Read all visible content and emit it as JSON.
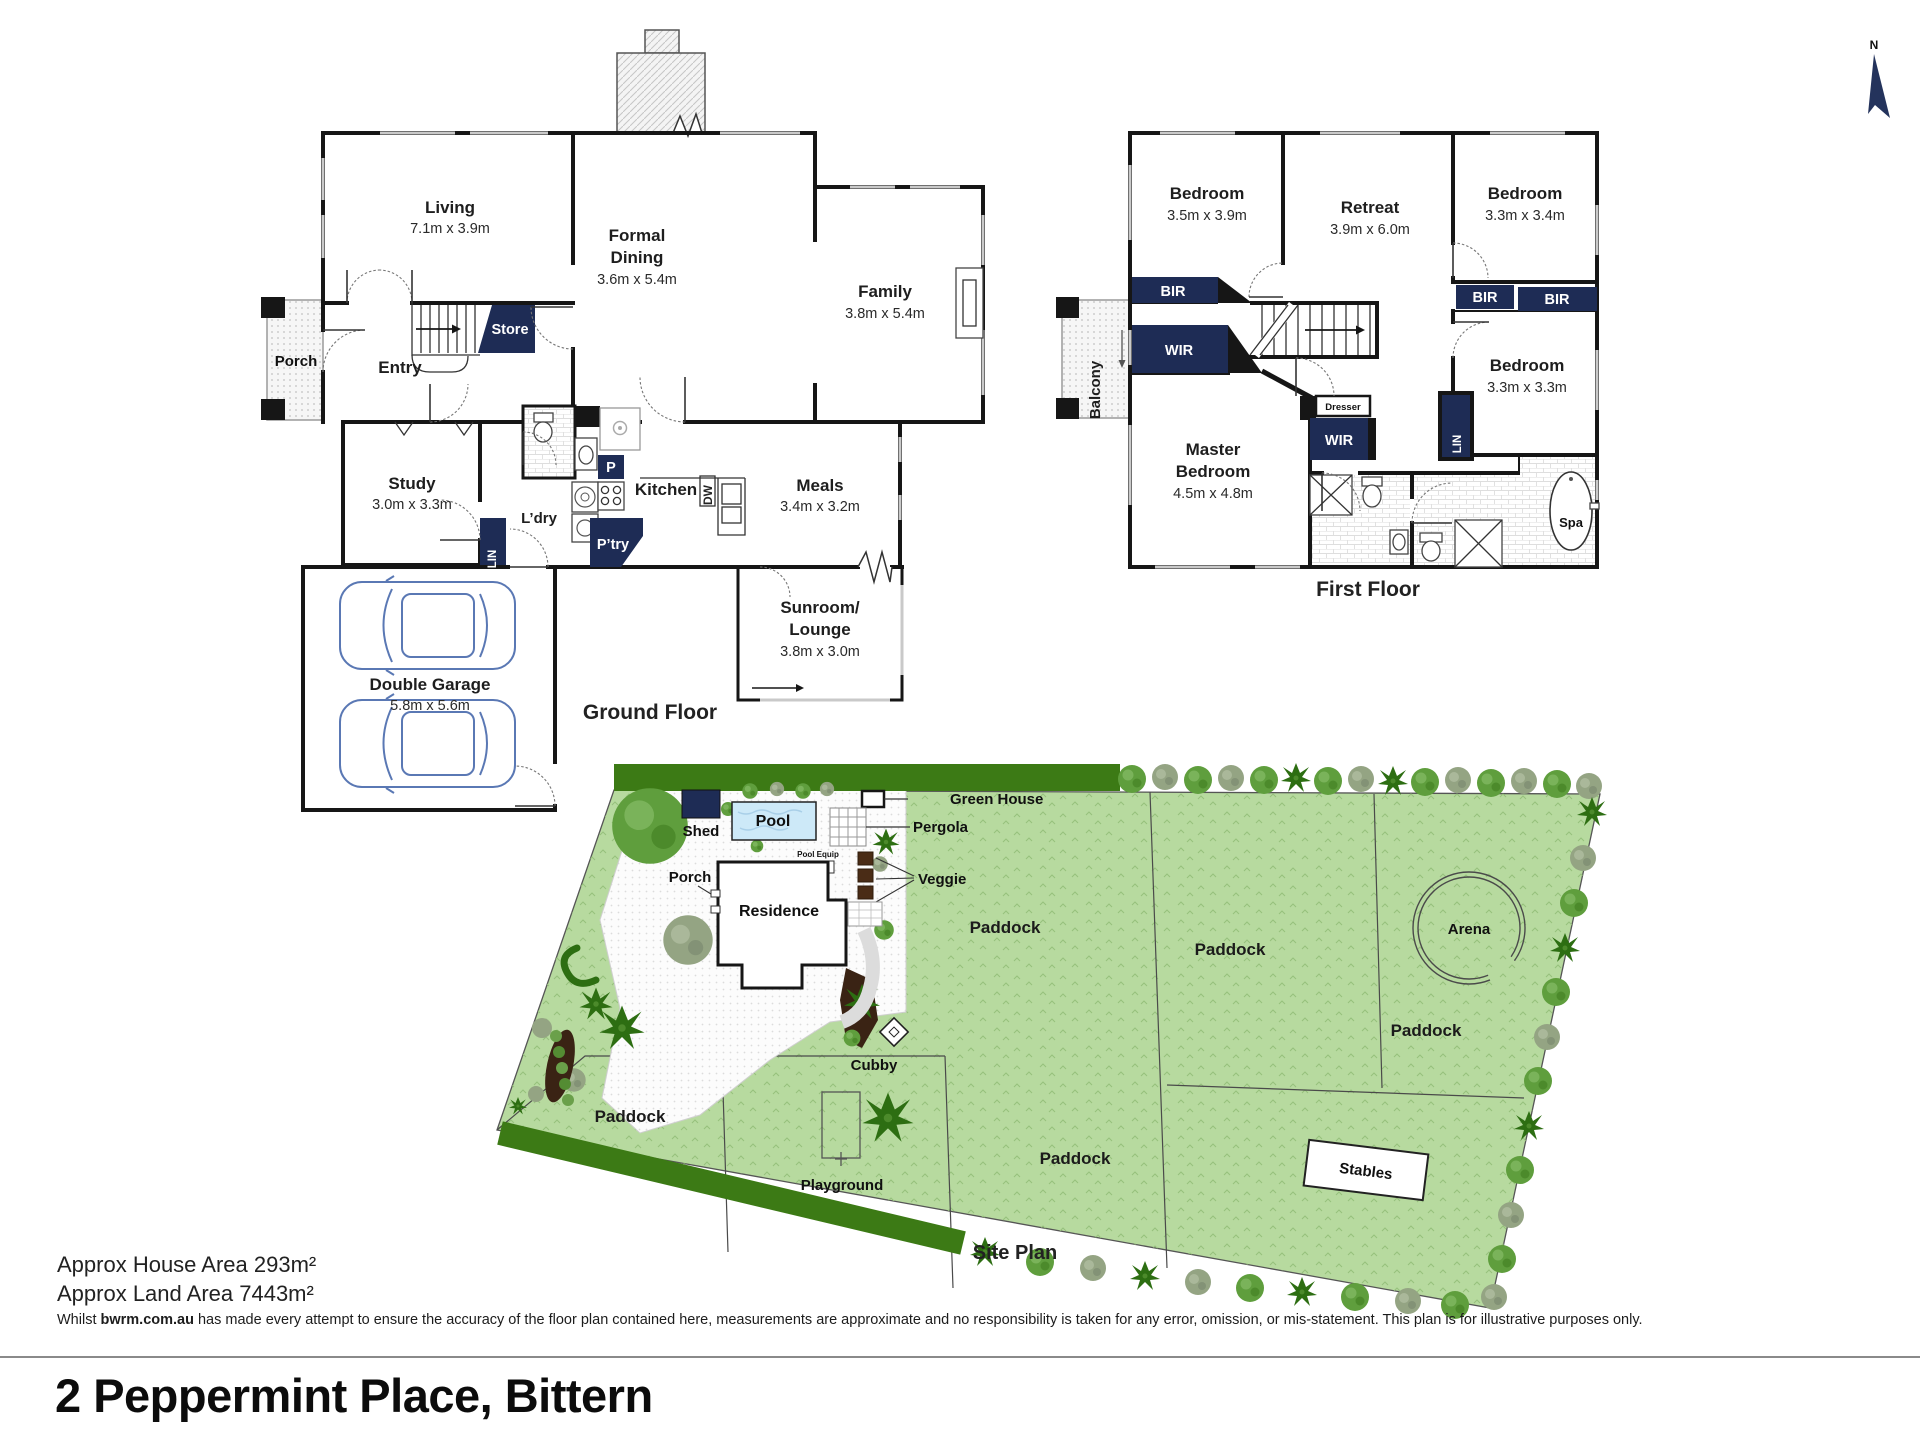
{
  "colors": {
    "navy": "#1e2c55",
    "wall": "#161616",
    "site_green": "#b7da9f",
    "hedge_green": "#3c7a15",
    "pool_blue": "#cde9f8",
    "garden_bed_brown": "#3a2314"
  },
  "north": {
    "label": "N"
  },
  "ground": {
    "caption": "Ground Floor",
    "living": {
      "name": "Living",
      "dims": "7.1m x 3.9m"
    },
    "dining": {
      "line1": "Formal",
      "line2": "Dining",
      "dims": "3.6m x 5.4m"
    },
    "family": {
      "name": "Family",
      "dims": "3.8m x 5.4m"
    },
    "porch": {
      "name": "Porch"
    },
    "entry": {
      "name": "Entry"
    },
    "store": {
      "name": "Store"
    },
    "study": {
      "name": "Study",
      "dims": "3.0m x 3.3m"
    },
    "lin": {
      "name": "LIN"
    },
    "ldry": {
      "name": "L’dry"
    },
    "p": {
      "name": "P"
    },
    "ptry": {
      "name": "P’try"
    },
    "kitchen": {
      "name": "Kitchen"
    },
    "dw": {
      "name": "DW"
    },
    "meals": {
      "name": "Meals",
      "dims": "3.4m x 3.2m"
    },
    "garage": {
      "name": "Double Garage",
      "dims": "5.8m x 5.6m"
    },
    "sunroom": {
      "line1": "Sunroom/",
      "line2": "Lounge",
      "dims": "3.8m x 3.0m"
    }
  },
  "first": {
    "caption": "First Floor",
    "bed1": {
      "name": "Bedroom",
      "dims": "3.5m x 3.9m"
    },
    "retreat": {
      "name": "Retreat",
      "dims": "3.9m x 6.0m"
    },
    "bed2": {
      "name": "Bedroom",
      "dims": "3.3m x 3.4m"
    },
    "bed3": {
      "name": "Bedroom",
      "dims": "3.3m x 3.3m"
    },
    "master": {
      "line1": "Master",
      "line2": "Bedroom",
      "dims": "4.5m x 4.8m"
    },
    "bir1": {
      "name": "BIR"
    },
    "bir2": {
      "name": "BIR"
    },
    "bir3": {
      "name": "BIR"
    },
    "wir1": {
      "name": "WIR"
    },
    "wir2": {
      "name": "WIR"
    },
    "lin": {
      "name": "LIN"
    },
    "balcony": {
      "name": "Balcony"
    },
    "dresser": {
      "name": "Dresser"
    },
    "spa": {
      "name": "Spa"
    }
  },
  "site": {
    "caption": "Site Plan",
    "shed": "Shed",
    "pool": "Pool",
    "green_house": "Green House",
    "pergola": "Pergola",
    "pool_equip": "Pool Equip",
    "veggie": "Veggie",
    "porch": "Porch",
    "residence": "Residence",
    "cubby": "Cubby",
    "playground": "Playground",
    "arena": "Arena",
    "stables": "Stables",
    "paddock_1": "Paddock",
    "paddock_2": "Paddock",
    "paddock_3": "Paddock",
    "paddock_4": "Paddock",
    "paddock_5": "Paddock"
  },
  "footer": {
    "house_area": "Approx House Area 293m²",
    "land_area": "Approx Land Area 7443m²",
    "disclaimer_pre": "Whilst ",
    "disclaimer_bold": "bwrm.com.au",
    "disclaimer_post": " has made every attempt to ensure the accuracy of the floor plan contained here, measurements are approximate and no responsibility is taken for any error, omission, or mis-statement. This plan is for illustrative purposes only.",
    "title": "2 Peppermint Place, Bittern"
  }
}
